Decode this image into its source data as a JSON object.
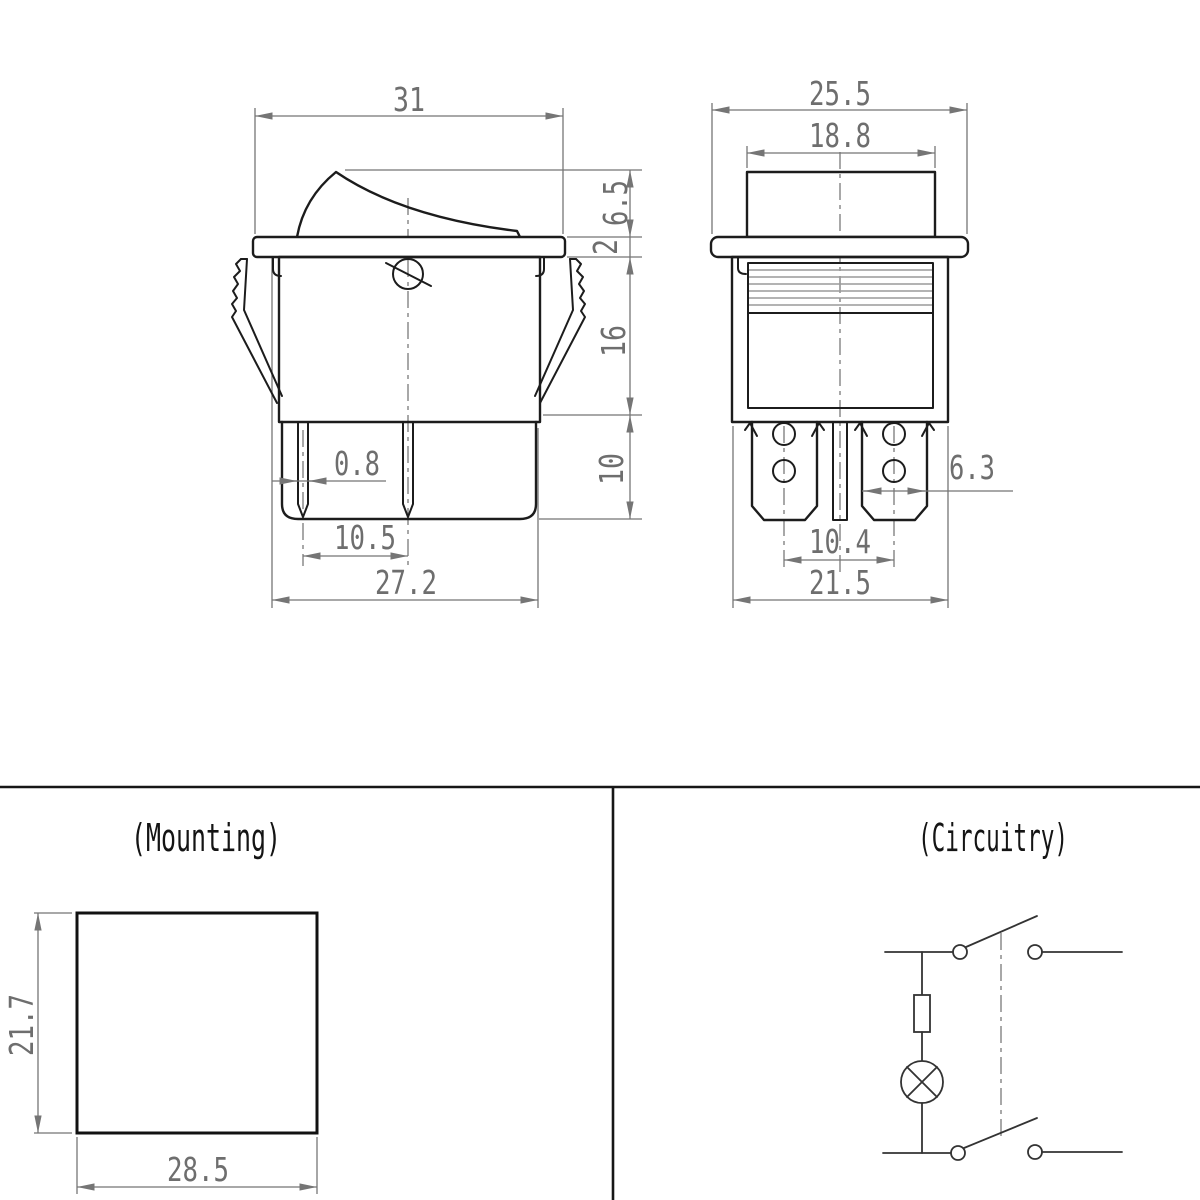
{
  "side_view": {
    "dims": {
      "top_width": "31",
      "rocker_height": "6.5",
      "flange_thickness": "2",
      "body_height": "16",
      "terminal_height": "10",
      "pin_thickness": "0.8",
      "pin_spacing": "10.5",
      "overall_width": "27.2"
    }
  },
  "front_view": {
    "dims": {
      "flange_width": "25.5",
      "rocker_width": "18.8",
      "terminal_width": "6.3",
      "terminal_spacing": "10.4",
      "body_width": "21.5"
    }
  },
  "mounting": {
    "title": "(Mounting)",
    "dims": {
      "hole_height": "21.7",
      "hole_width": "28.5"
    }
  },
  "circuitry": {
    "title": "(Circuitry)"
  },
  "colors": {
    "object_line": "#1c1c1c",
    "dimension_line": "#757575",
    "background": "#ffffff"
  }
}
